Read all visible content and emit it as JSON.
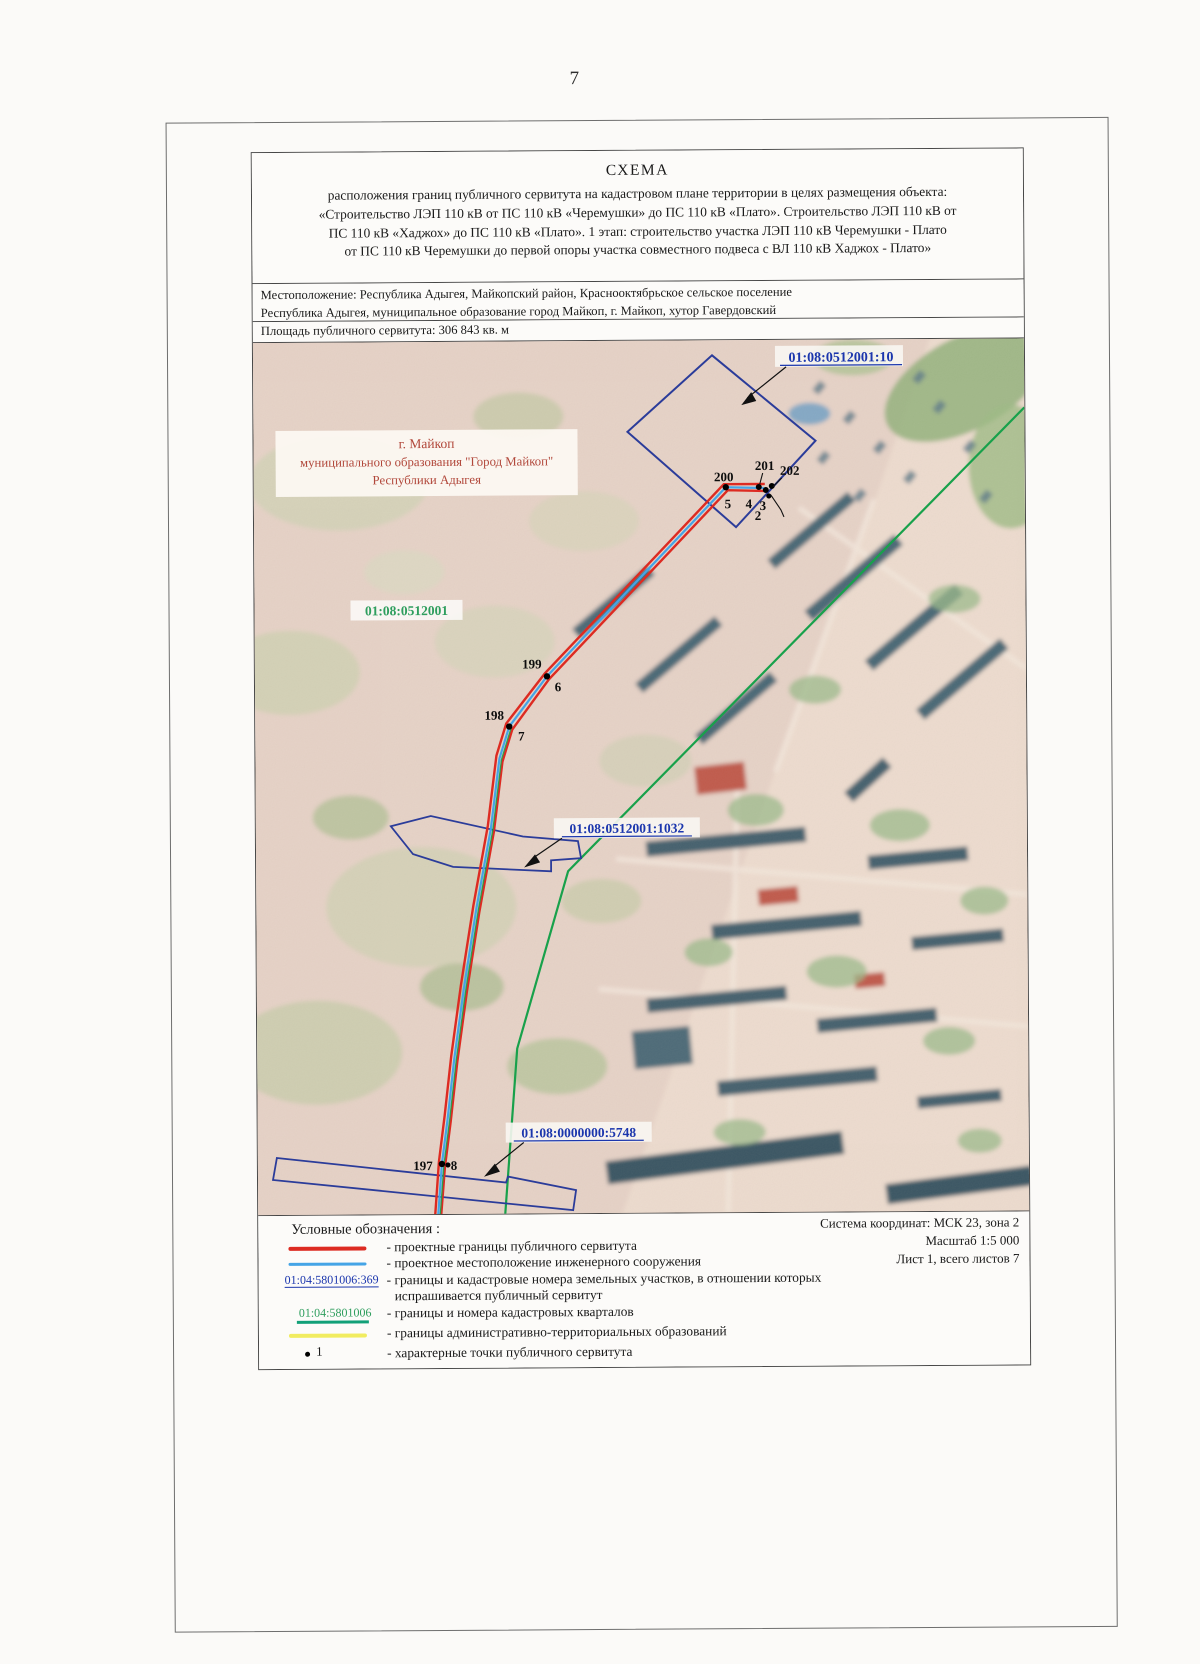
{
  "page": {
    "number": "7"
  },
  "title": {
    "heading": "СХЕМА",
    "line1": "расположения границ публичного сервитута на кадастровом плане территории в целях размещения объекта:",
    "line2": "«Строительство ЛЭП 110 кВ от ПС 110 кВ «Черемушки» до ПС 110 кВ «Плато». Строительство ЛЭП 110 кВ от",
    "line3": "ПС 110 кВ «Хаджох» до ПС 110 кВ «Плато». 1 этап: строительство участка ЛЭП 110 кВ Черемушки - Плато",
    "line4": "от ПС 110 кВ Черемушки до первой опоры участка совместного подвеса с ВЛ 110 кВ Хаджох - Плато»"
  },
  "location": {
    "line1": "Местоположение: Республика Адыгея,  Майкопский район, Краснооктябрьское сельское поселение",
    "line2": "Республика Адыгея, муниципальное образование город Майкоп, г. Майкоп, хутор Гавердовский"
  },
  "area_label": "Площадь публичного сервитута: 306 843 кв. м",
  "map": {
    "cadastral_labels": {
      "parcel_10": "01:08:0512001:10",
      "quarter": "01:08:0512001",
      "parcel_1032": "01:08:0512001:1032",
      "parcel_5748": "01:08:0000000:5748"
    },
    "territory_label": {
      "line1": "г. Майкоп",
      "line2": "муниципального образования \"Город Майкоп\"",
      "line3": "Республики Адыгея"
    },
    "points": {
      "p200": "200",
      "p201": "201",
      "p202": "202",
      "p199": "199",
      "p198": "198",
      "p197": "197",
      "n2": "2",
      "n3": "3",
      "n4": "4",
      "n5": "5",
      "n6": "6",
      "n7": "7",
      "n8": "8"
    }
  },
  "legend": {
    "title": "Условные обозначения :",
    "items": [
      {
        "text": "- проектные границы публичного сервитута"
      },
      {
        "text": "- проектное местоположение инженерного сооружения"
      },
      {
        "swatch": "01:04:5801006:369",
        "text": "- границы и кадастровые номера земельных участков, в отношении которых",
        "text2": "испрашивается публичный сервитут"
      },
      {
        "swatch": "01:04:5801006",
        "text": "- границы и номера кадастровых кварталов"
      },
      {
        "text": "- границы административно-территориальных образований"
      },
      {
        "swatch": "1",
        "text": "- характерные точки публичного сервитута"
      }
    ]
  },
  "info": {
    "coord_system": "Система координат: МСК 23, зона 2",
    "scale": "Масштаб 1:5 000",
    "sheet": "Лист 1, всего листов 7"
  },
  "colors": {
    "servitude_red": "#dd2b22",
    "engineering_blue": "#45a4e6",
    "parcel_outline_blue": "#2b3c9a",
    "cadastral_label_blue": "#1b36ad",
    "quarter_green": "#18a14b",
    "admin_yellow": "#f1ec60"
  }
}
